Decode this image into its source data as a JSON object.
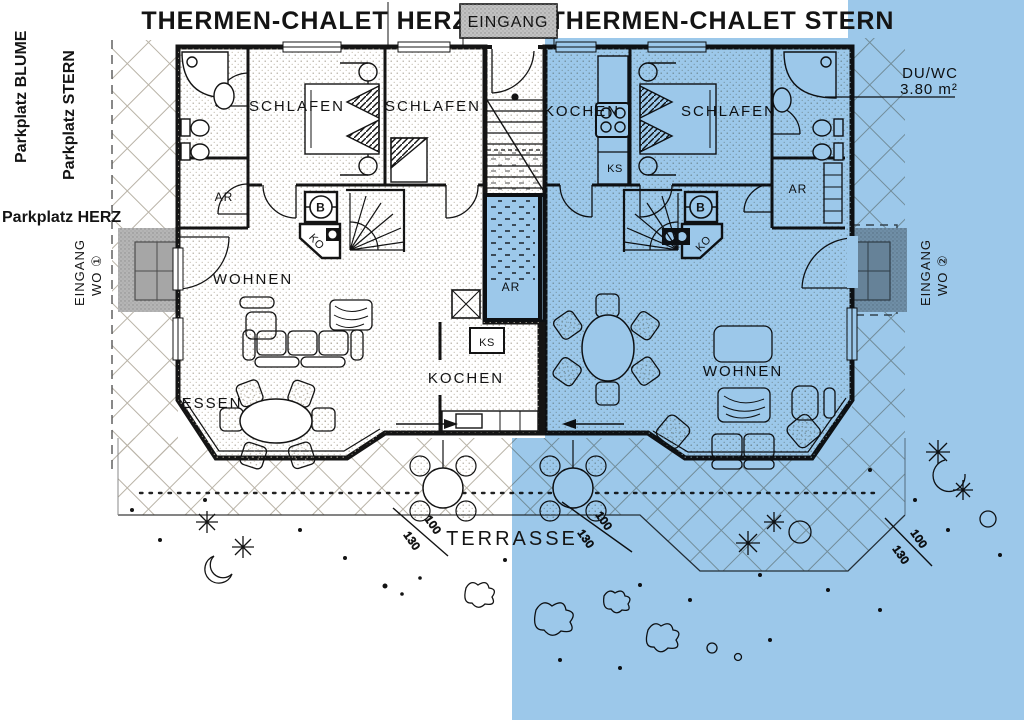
{
  "colors": {
    "ink": "#141414",
    "overlay_blue": "#9cc8ea",
    "paper": "#ffffff",
    "entry_gray": "#b5b5b5"
  },
  "header": {
    "title_left": "THERMEN-CHALET HERZ",
    "title_right": "THERMEN-CHALET STERN",
    "entrance_label": "EINGANG"
  },
  "site": {
    "parkplatz_blume": "Parkplatz BLUME",
    "parkplatz_stern": "Parkplatz STERN",
    "parkplatz_herz": "Parkplatz HERZ",
    "entrance_wo1_line1": "EINGANG",
    "entrance_wo1_line2": "WO ①",
    "entrance_wo2_line1": "EINGANG",
    "entrance_wo2_line2": "WO ②",
    "terrace_label": "TERRASSE",
    "bath_annotation_line1": "DU/WC",
    "bath_annotation_line2": "3.80 m²",
    "dim_100": "100",
    "dim_130": "130"
  },
  "chalet_herz": {
    "schlafen1": "SCHLAFEN",
    "schlafen2": "SCHLAFEN",
    "ar": "AR",
    "wohnen": "WOHNEN",
    "essen": "ESSEN",
    "kochen": "KOCHEN",
    "ks": "KS",
    "ko": "KO",
    "boiler": "B"
  },
  "chalet_stern": {
    "kochen": "KOCHEN",
    "ks": "KS",
    "schlafen": "SCHLAFEN",
    "ar_bath": "AR",
    "ar_center": "AR",
    "wohnen": "WOHNEN",
    "ko": "KO",
    "boiler": "B"
  }
}
